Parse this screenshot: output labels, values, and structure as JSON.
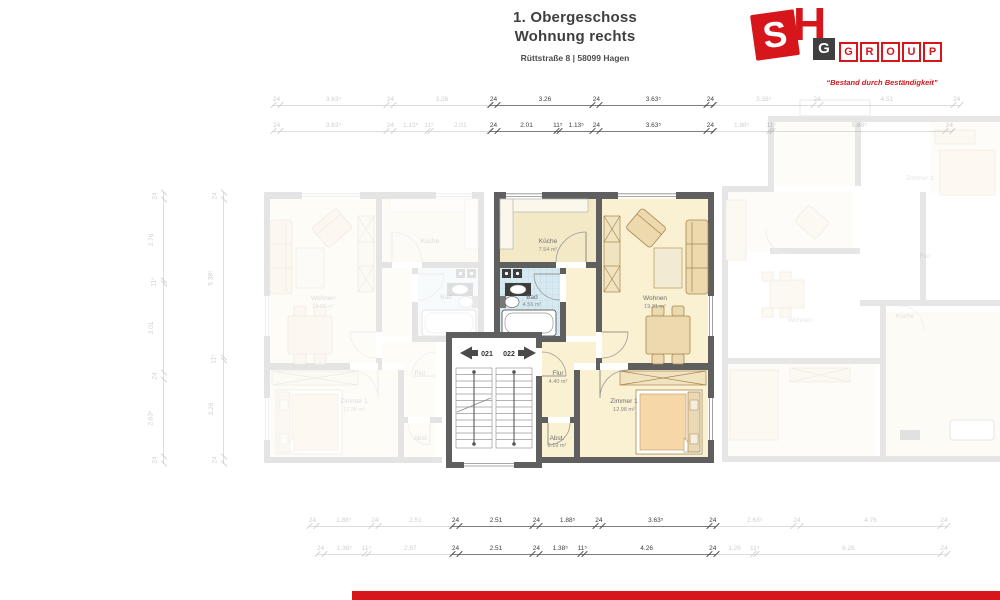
{
  "header": {
    "title_line1": "1. Obergeschoss",
    "title_line2": "Wohnung rechts",
    "address": "Rüttstraße 8 | 58099 Hagen"
  },
  "logo": {
    "s": "S",
    "h": "H",
    "g": "G",
    "group": [
      "G",
      "R",
      "O",
      "U",
      "P"
    ],
    "tagline": "“Bestand durch Beständigkeit”",
    "accent_color": "#d6161b"
  },
  "rooms": {
    "kueche": {
      "name": "Küche",
      "area": "7.54 m²"
    },
    "bad": {
      "name": "Bad",
      "area": "4.56 m²"
    },
    "wohnen": {
      "name": "Wohnen",
      "area": "19.31 m²"
    },
    "flur": {
      "name": "Flur",
      "area": "4.40 m²"
    },
    "zimmer1": {
      "name": "Zimmer 1",
      "area": "12.98 m²"
    },
    "abst": {
      "name": "Abst.",
      "area": "2.19 m²"
    }
  },
  "stairwell": {
    "left_unit": "021",
    "right_unit": "022"
  },
  "dimensions": {
    "top_main": [
      [
        "24",
        "3.26",
        "24",
        "3.63⁵",
        "24"
      ],
      [
        "24",
        "2.01",
        "11⁵",
        "1.13⁵",
        "24",
        "3.63⁵",
        "24"
      ]
    ],
    "bottom_main": [
      [
        "24",
        "2.51",
        "24",
        "1.88⁵",
        "24",
        "3.63⁵",
        "24"
      ],
      [
        "24",
        "2.51",
        "24",
        "1.38⁵",
        "11⁵",
        "4.26",
        "24"
      ]
    ],
    "top_left_faded": [
      [
        "24",
        "3.63⁵",
        "24",
        "3.26"
      ],
      [
        "24",
        "3.63⁵",
        "24",
        "1.13⁵",
        "11⁵",
        "2.01"
      ]
    ],
    "top_right_faded": [
      [
        "3.38⁵",
        "24",
        "4.51",
        "24"
      ],
      [
        "1.88⁵",
        "11⁵",
        "5.88⁵",
        "24"
      ]
    ],
    "bottom_left_faded": [
      [
        "24",
        "1.88⁵",
        "24",
        "2.51"
      ],
      [
        "24",
        "1.38⁵",
        "11⁵",
        "2.87"
      ]
    ],
    "bottom_right_faded": [
      [
        "2.63⁵",
        "24",
        "4.76",
        "24"
      ],
      [
        "1.26",
        "11⁵",
        "6.26",
        "24"
      ]
    ],
    "left_vertical_faded": [
      [
        "24",
        "2.76",
        "11⁵",
        "3.01",
        "24",
        "2.63⁵",
        "24"
      ],
      [
        "24",
        "5.38⁵",
        "11⁵",
        "3.26",
        "24"
      ]
    ]
  },
  "colors": {
    "accent_red": "#d6161b",
    "wall": "#5f5f5f",
    "room_cream": "#f9f1d2",
    "kitchen_cream": "#f3e9c6",
    "bath_blue": "#d8eaf1",
    "furniture": "#edd9ae"
  }
}
